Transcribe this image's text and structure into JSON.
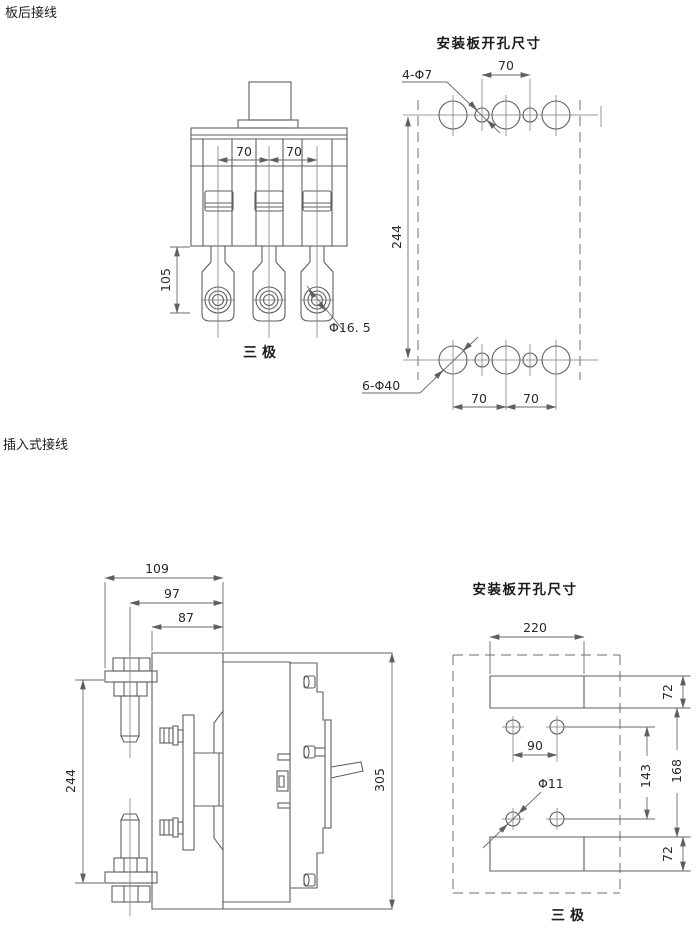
{
  "sections": {
    "rear_wiring_label": "板后接线",
    "plugin_wiring_label": "插入式接线"
  },
  "rear_connection": {
    "front_view": {
      "dim_pole_spacing_left": "70",
      "dim_pole_spacing_right": "70",
      "dim_terminal_length": "105",
      "terminal_hole_callout": "Φ16. 5",
      "caption": "三极"
    },
    "drill_plan": {
      "title": "安装板开孔尺寸",
      "small_hole_callout": "4-Φ7",
      "dim_top_spacing": "70",
      "dim_height": "244",
      "large_hole_callout": "6-Φ40",
      "dim_bottom_spacing_left": "70",
      "dim_bottom_spacing_right": "70"
    }
  },
  "plugin_connection": {
    "side_view": {
      "dim_depth_overall": "109",
      "dim_depth_stud": "97",
      "dim_depth_plate": "87",
      "dim_stud_spacing": "244",
      "dim_height_overall": "305"
    },
    "drill_plan": {
      "title": "安装板开孔尺寸",
      "dim_slot_width": "220",
      "dim_slot_height_top": "72",
      "dim_hole_spacing_h": "90",
      "dim_hole_spacing_v": "143",
      "dim_slot_gap": "168",
      "hole_callout": "Φ11",
      "dim_slot_height_bottom": "72",
      "caption": "三极"
    }
  }
}
